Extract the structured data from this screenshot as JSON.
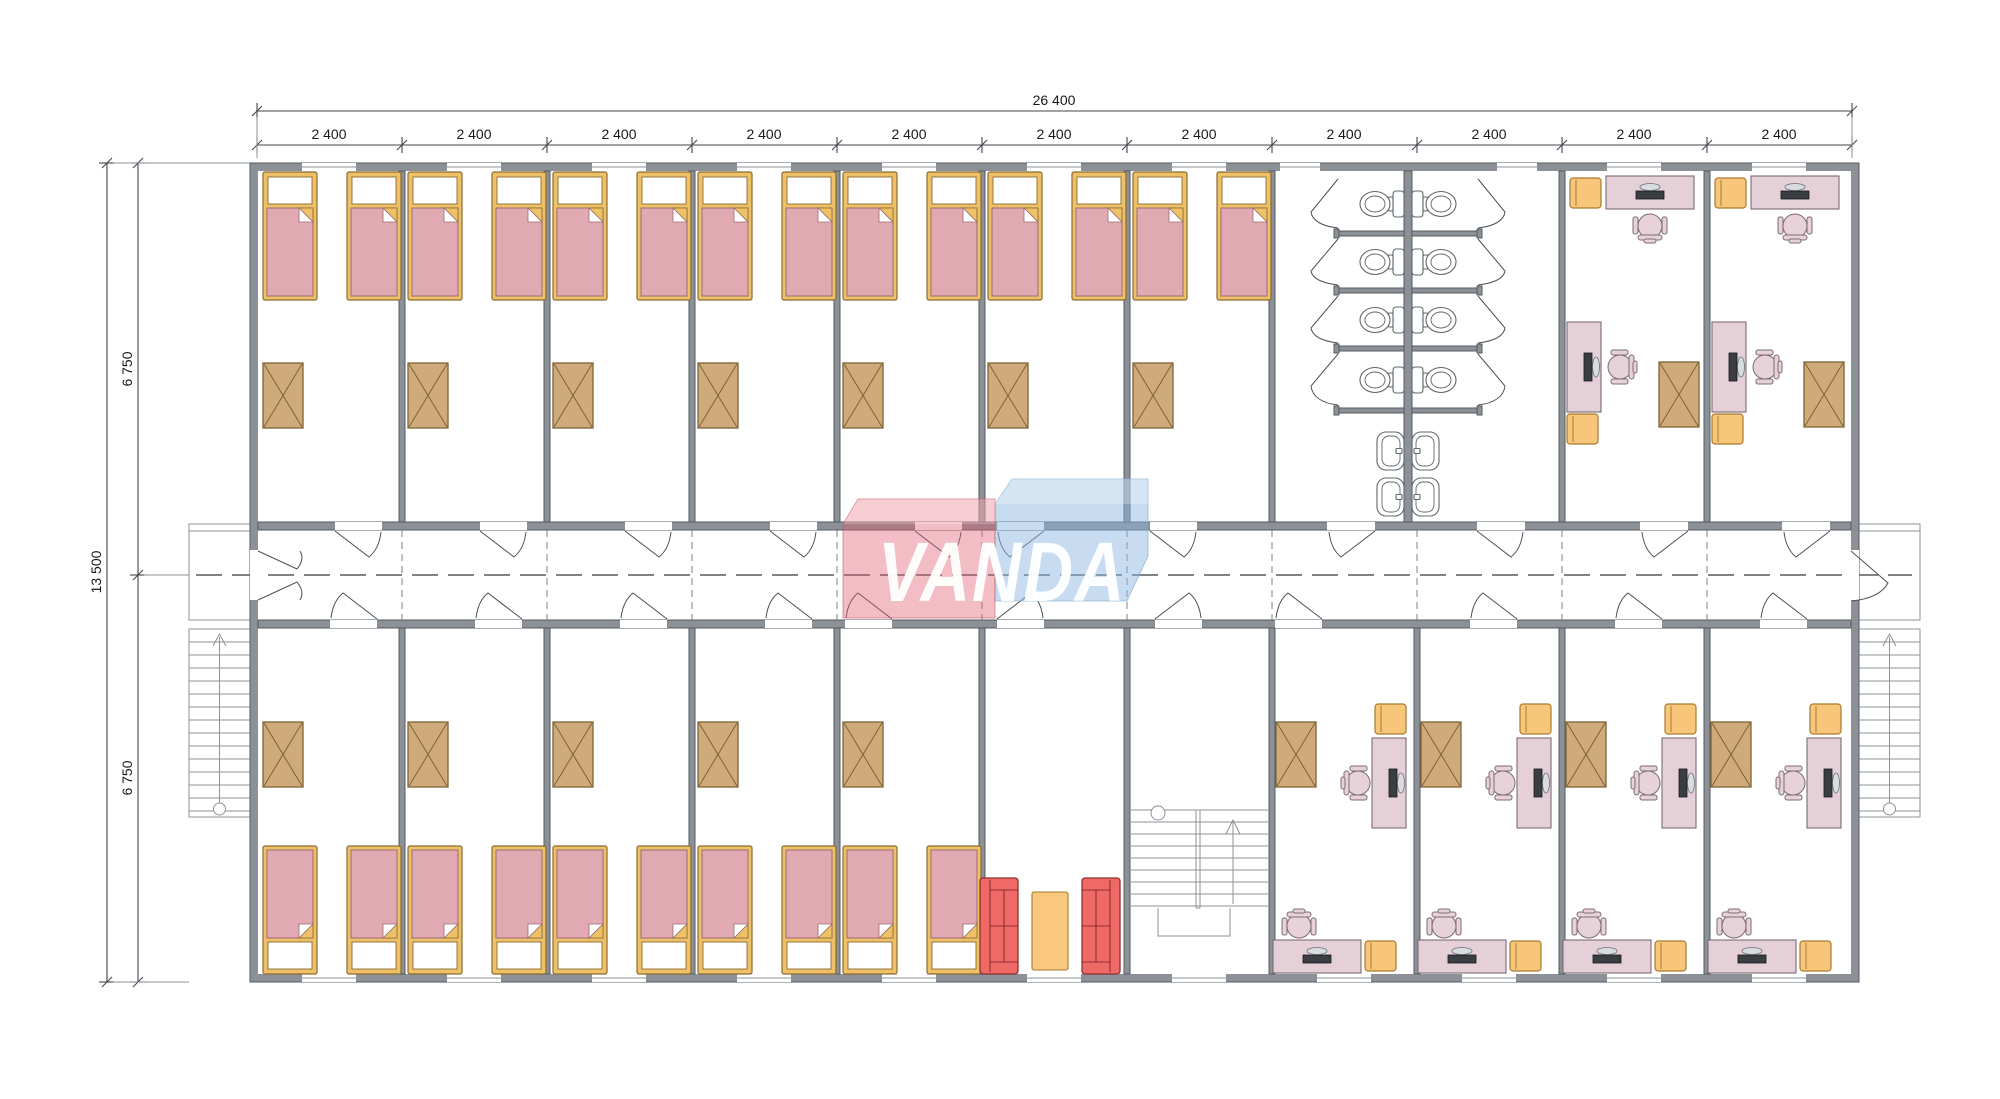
{
  "dimensions": {
    "total_width_label": "26 400",
    "module_width_label": "2 400",
    "module_count": 11,
    "total_height_label": "13 500",
    "half_height_label": "6 750",
    "half_count": 2
  },
  "logo": {
    "text": "VANDA"
  },
  "colors": {
    "wall": "#8b9196",
    "wall_outline": "#565b61",
    "line": "#3f444a",
    "bed_frame": "#eec167",
    "bed_frame_outline": "#8a6b33",
    "bed_blanket": "#e1aab2",
    "bed_blanket_outline": "#9c6b74",
    "wardrobe": "#cfab7c",
    "wardrobe_outline": "#7d6234",
    "desk": "#e6d0d8",
    "desk_outline": "#7b6b72",
    "chair": "#e8d2da",
    "yellow": "#f8c67b",
    "yellow_outline": "#a87a2e",
    "sofa": "#ef6a66",
    "sofa_outline": "#8e2f2e",
    "table": "#f9c77e",
    "fixture_outline": "#60666c",
    "logo_red": "#e2596f",
    "logo_blue": "#8ab6e0"
  },
  "plan": {
    "top_row_rooms": [
      "bedroom",
      "bedroom",
      "bedroom",
      "bedroom",
      "bedroom",
      "bedroom",
      "bedroom",
      "washroom",
      "washroom",
      "office",
      "office"
    ],
    "bottom_row_rooms": [
      "bedroom",
      "bedroom",
      "bedroom",
      "bedroom",
      "bedroom",
      "lounge",
      "stairwell",
      "office",
      "office",
      "office",
      "office"
    ],
    "furniture_counts": {
      "beds": 24,
      "wardrobes": 18,
      "toilets": 8,
      "sinks": 4,
      "desks": 12,
      "office_chairs": 12,
      "stools": 12,
      "sofas": 2,
      "tables": 1,
      "external_staircases": 2,
      "internal_staircases": 1
    }
  }
}
